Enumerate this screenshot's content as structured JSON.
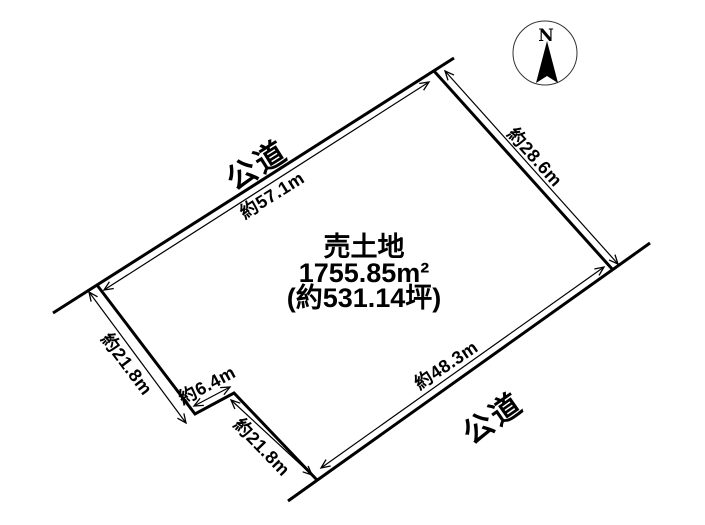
{
  "plot": {
    "title": "売土地",
    "area_sqm": "1755.85m²",
    "area_tsubo": "(約531.14坪)"
  },
  "roads": {
    "top_label": "公道",
    "bottom_label": "公道"
  },
  "dimensions": {
    "top_edge": "約57.1m",
    "right_edge": "約28.6m",
    "bottom_edge": "約48.3m",
    "left_edge": "約21.8m",
    "notch_upper": "約6.4m",
    "notch_lower": "約21.8m"
  },
  "compass": {
    "north_label": "N"
  },
  "colors": {
    "ink": "#000000",
    "background": "#ffffff",
    "compass_ring": "#333333"
  }
}
